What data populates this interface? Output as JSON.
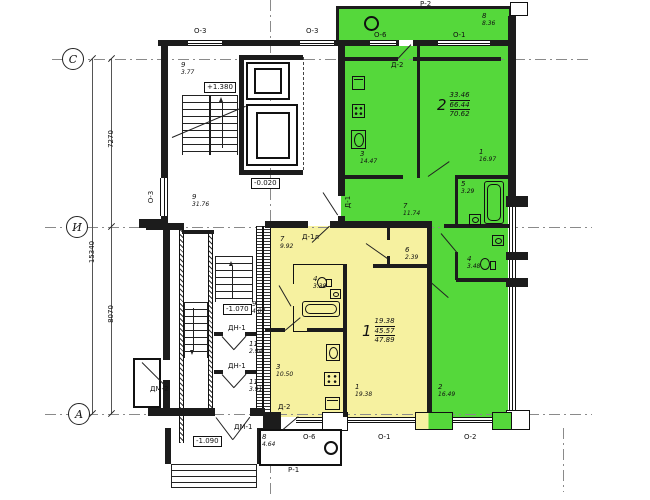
{
  "axes": {
    "c": "С",
    "i": "И",
    "a": "А"
  },
  "dims": {
    "total": "15340",
    "upper": "7270",
    "lower": "8070"
  },
  "elev": {
    "up": "+1.380",
    "lobby": "-0.020",
    "mid": "-1.070",
    "entry": "-1.090"
  },
  "marks": {
    "o1": "О-1",
    "o2": "О-2",
    "o3": "О-3",
    "o6": "О-6",
    "p1": "Р-1",
    "p2": "Р-2",
    "d1": "Д-1",
    "d1l": "Д-1л",
    "d2": "Д-2",
    "dn1": "ДН-1",
    "dm1": "ДМ-1",
    "dm2": "ДМ-2"
  },
  "apartments": {
    "apt2": {
      "num": "2",
      "living": "33.46",
      "usable": "66.44",
      "total": "70.62"
    },
    "apt1": {
      "num": "1",
      "living": "19.38",
      "usable": "45.57",
      "total": "47.89"
    }
  },
  "rooms": {
    "land9": {
      "num": "9",
      "area": "3.77"
    },
    "lobby9": {
      "num": "9",
      "area": "31.76"
    },
    "bal8": {
      "num": "8",
      "area": "8.36"
    },
    "g3": {
      "num": "3",
      "area": "14.47"
    },
    "g1": {
      "num": "1",
      "area": "16.97"
    },
    "g5": {
      "num": "5",
      "area": "3.29"
    },
    "g7": {
      "num": "7",
      "area": "11.74"
    },
    "g4": {
      "num": "4",
      "area": "3.48"
    },
    "g2": {
      "num": "2",
      "area": "16.49"
    },
    "y7": {
      "num": "7",
      "area": "9.92"
    },
    "y4": {
      "num": "4",
      "area": "3.38"
    },
    "y6": {
      "num": "6",
      "area": "2.39"
    },
    "y3": {
      "num": "3",
      "area": "10.50"
    },
    "y1": {
      "num": "1",
      "area": "19.38"
    },
    "mid9": {
      "num": "9",
      "area": "4.07"
    },
    "v11a": {
      "num": "11",
      "area": "2.94"
    },
    "v11b": {
      "num": "11",
      "area": "3.91"
    },
    "pb8": {
      "num": "8",
      "area": "4.64"
    }
  },
  "colors": {
    "apt2_fill": "#55d83b",
    "apt1_fill": "#f6f1a0",
    "wall": "#1c1c1c"
  }
}
